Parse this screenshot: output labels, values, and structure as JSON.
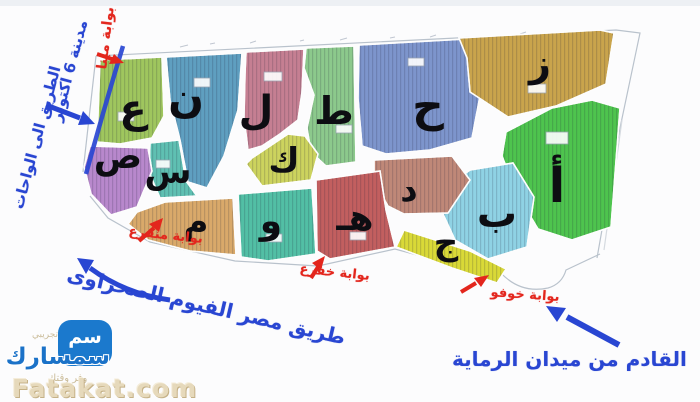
{
  "map": {
    "districts": [
      {
        "letter": "ع",
        "color": "#9fc65e"
      },
      {
        "letter": "ن",
        "color": "#5f9fc0"
      },
      {
        "letter": "ل",
        "color": "#c57f92"
      },
      {
        "letter": "ط",
        "color": "#8cc98c"
      },
      {
        "letter": "ح",
        "color": "#7d95cc"
      },
      {
        "letter": "ز",
        "color": "#c9a44c"
      },
      {
        "letter": "أ",
        "color": "#4ec44e"
      },
      {
        "letter": "ب",
        "color": "#8fd2e4"
      },
      {
        "letter": "ج",
        "color": "#d9d937"
      },
      {
        "letter": "د",
        "color": "#bf8878"
      },
      {
        "letter": "هـ",
        "color": "#c25f5f"
      },
      {
        "letter": "و",
        "color": "#52bfa5"
      },
      {
        "letter": "م",
        "color": "#d9a96a"
      },
      {
        "letter": "س",
        "color": "#5fc0b2"
      },
      {
        "letter": "ص",
        "color": "#b888cc"
      },
      {
        "letter": "ك",
        "color": "#ccd35e"
      }
    ],
    "gates": [
      {
        "name": "بوابة مينا"
      },
      {
        "name": "بوابة منقرع"
      },
      {
        "name": "بوابة خفرع"
      },
      {
        "name": "بوابة خوفو"
      }
    ],
    "roads": {
      "west_label_line1": "مدينة 6 اكتوبر",
      "west_label_line2": "الطريق الى الواحات",
      "south_road": "طريق مصر الفيوم الصحراوى",
      "southeast_label": "القادم من ميدان الرماية"
    },
    "colors": {
      "gate_text": "#e3261d",
      "road_text": "#2946d2"
    }
  },
  "watermark": {
    "logo_text": "سمسارك",
    "logo_glyph": "سم",
    "tagline_top": "تجريبي",
    "tagline_bottom": "وفر وقتك",
    "site": "Fatakat.com"
  }
}
